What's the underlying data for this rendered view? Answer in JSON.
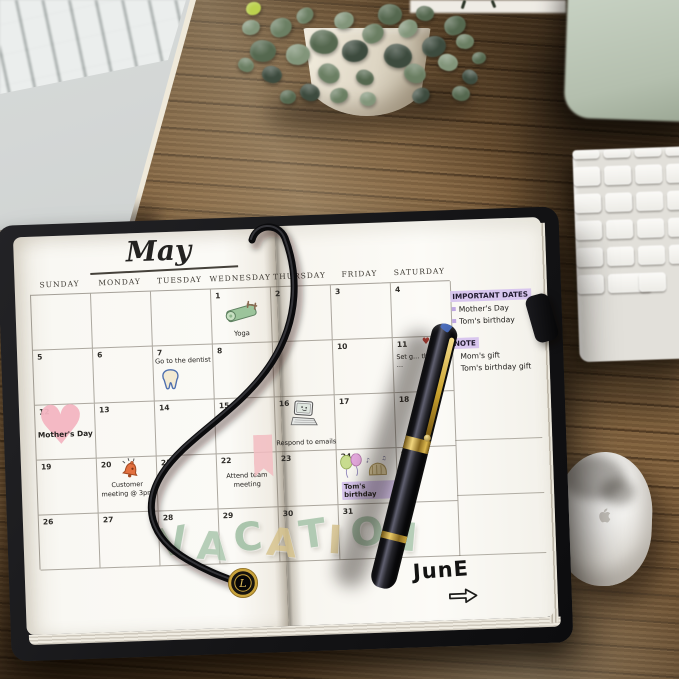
{
  "scene": {
    "objects": [
      {
        "name": "laptop-computer"
      },
      {
        "name": "potted-plant"
      },
      {
        "name": "monitor-corner"
      },
      {
        "name": "wireless-keyboard"
      },
      {
        "name": "computer-mouse"
      },
      {
        "name": "planner-notebook"
      },
      {
        "name": "fountain-pen"
      },
      {
        "name": "elastic-band-with-charm"
      }
    ]
  },
  "calendar": {
    "title": "May",
    "weekday_headers": [
      "SUNDAY",
      "MONDAY",
      "TUESDAY",
      "WEDNESDAY",
      "THURSDAY",
      "FRIDAY",
      "SATURDAY"
    ],
    "weeks": [
      [
        "",
        "",
        "",
        "1",
        "2",
        "3",
        "4"
      ],
      [
        "5",
        "6",
        "7",
        "8",
        "9",
        "10",
        "11"
      ],
      [
        "12",
        "13",
        "14",
        "15",
        "16",
        "17",
        "18"
      ],
      [
        "19",
        "20",
        "21",
        "22",
        "23",
        "24",
        "25"
      ],
      [
        "26",
        "27",
        "28",
        "29",
        "30",
        "31",
        ""
      ]
    ],
    "entries": [
      {
        "date": "1",
        "text": "Yoga",
        "icon": "yoga-mat-icon"
      },
      {
        "date": "7",
        "text": "Go to the dentist",
        "icon": "tooth-icon"
      },
      {
        "date": "11",
        "text": "Set g… the …",
        "icon": "small-heart-icon"
      },
      {
        "date": "12",
        "text": "Mother's Day",
        "icon": "pink-heart-sticker-icon"
      },
      {
        "date": "16",
        "text": "Respond to emails",
        "icon": "laptop-doodle-icon"
      },
      {
        "date": "20",
        "text": "Customer meeting @ 3pm",
        "icon": "alarm-bell-icon"
      },
      {
        "date": "22",
        "text": "Attend team meeting",
        "icon": ""
      },
      {
        "date": "24",
        "text": "Tom's birthday",
        "icon": "balloons-and-cake-icon",
        "highlight": "#d8c6ee"
      }
    ],
    "stickers": [
      {
        "name": "pink-banner-sticker",
        "near_date": "23"
      },
      {
        "name": "vacation-letters-sticker",
        "text": "VACATION"
      }
    ],
    "vacation_letters": [
      {
        "ch": "V",
        "color": "#9fbfa4"
      },
      {
        "ch": "A",
        "color": "#a8c5ab"
      },
      {
        "ch": "C",
        "color": "#9abb9e"
      },
      {
        "ch": "A",
        "color": "#d7c38c"
      },
      {
        "ch": "T",
        "color": "#a2c1a6"
      },
      {
        "ch": "I",
        "color": "#d7c38c"
      },
      {
        "ch": "O",
        "color": "#9fbfa3"
      },
      {
        "ch": "N",
        "color": "#a8c5ab"
      }
    ],
    "next_month_label": "JunE",
    "next_month_arrow_icon": "right-arrow-icon"
  },
  "notes_panel": {
    "important_title": "IMPORTANT DATES",
    "important_items": [
      "Mother's Day",
      "Tom's birthday"
    ],
    "note_title": "NOTE",
    "note_items": [
      "Mom's gift",
      "Tom's birthday gift"
    ],
    "highlight_color": "#d8c6ee",
    "bullet_color": "#bfa7e2"
  }
}
